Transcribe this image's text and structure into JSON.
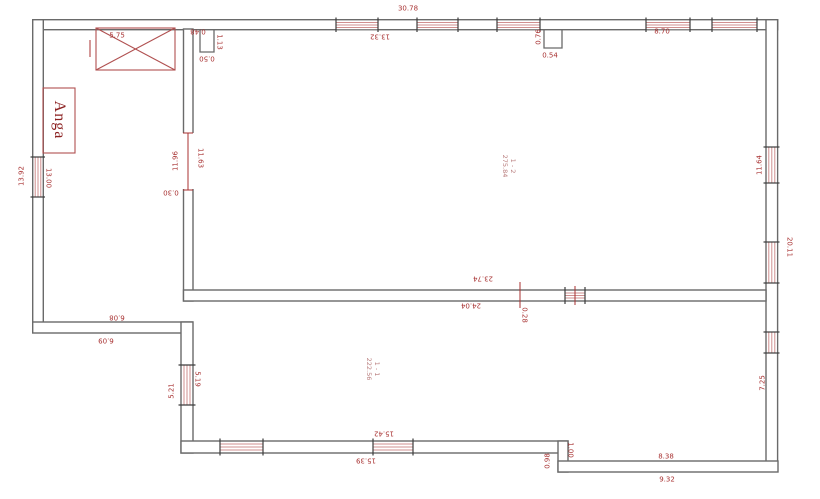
{
  "title": "floor-plan-drawing",
  "colors": {
    "wall_line": "#6a6a6a",
    "dimension_text": "#a83232",
    "window_hatch": "#cf8f8f",
    "symbol_red": "#b05050",
    "end_tick": "#3c3c3c",
    "background": "#ffffff"
  },
  "rooms": {
    "room_1_2": {
      "name": "1 - 2",
      "area": "275.84"
    },
    "room_1_1": {
      "name": "1 - 1",
      "area": "222.56"
    },
    "anga_label": "Anga"
  },
  "dimensions": {
    "top": {
      "d5_75": "5.75",
      "d0_48": "0.48",
      "d1_13": "1.13",
      "d0_50": "0.50",
      "d30_78": "30.78",
      "d13_32": "13.32",
      "d0_76": "0.76",
      "d0_54": "0.54",
      "d8_70": "8.70"
    },
    "left": {
      "d13_92": "13.92",
      "d13_00": "13.00"
    },
    "inner_wall": {
      "d11_96": "11.96",
      "d11_63": "11.63",
      "d0_30": "0.30"
    },
    "right": {
      "d11_64": "11.64",
      "d20_11": "20.11",
      "d7_25": "7.25"
    },
    "middle_wall": {
      "d23_74": "23.74",
      "d24_04": "24.04",
      "d0_28": "0.28"
    },
    "step": {
      "d6_08": "6.08",
      "d6_09": "6.09",
      "d5_21": "5.21",
      "d5_19": "5.19"
    },
    "bottom": {
      "d15_42": "15.42",
      "d15_39": "15.39",
      "d0_98": "0.98",
      "d1_00": "1.00",
      "d8_38": "8.38",
      "d9_32": "9.32"
    }
  }
}
